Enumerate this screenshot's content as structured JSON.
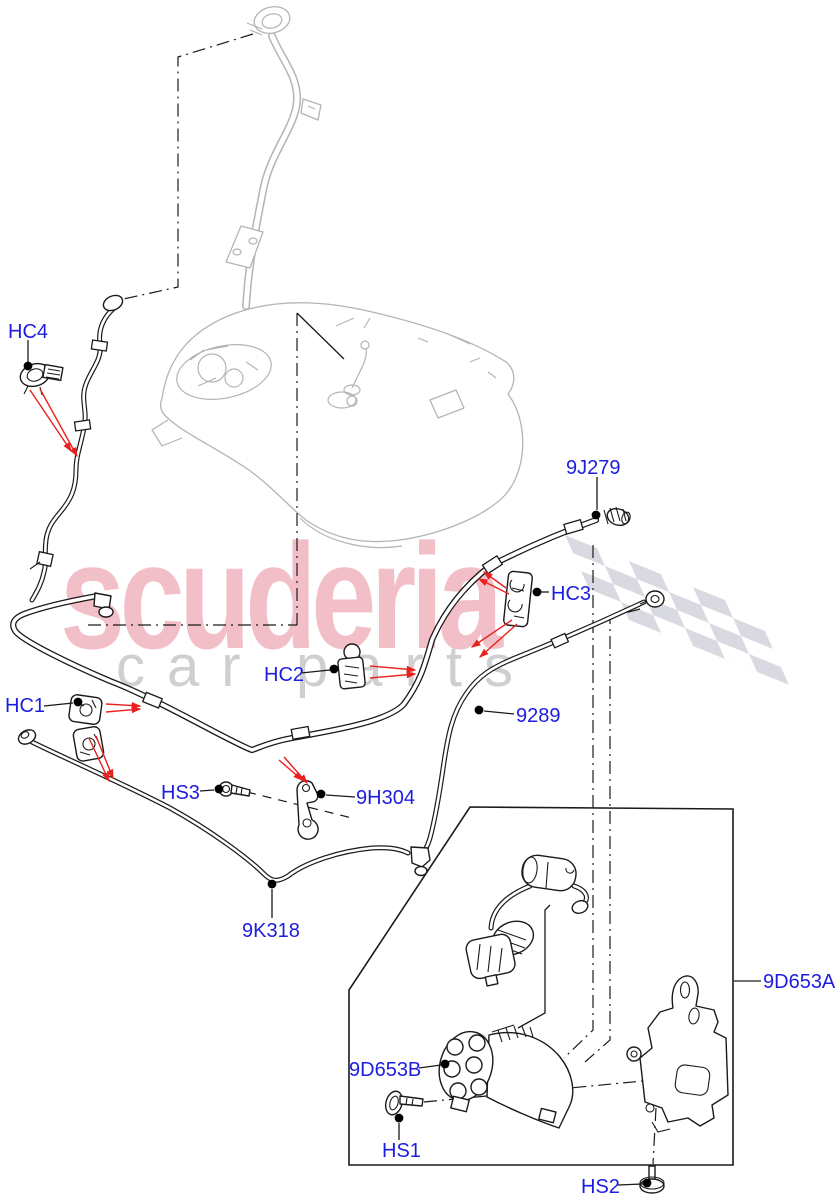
{
  "watermark": {
    "brand": "scuderia",
    "tagline_left": "car",
    "tagline_right": "parts"
  },
  "colors": {
    "label_blue": "#1d1de0",
    "arrow_red": "#e8211e",
    "watermark_pink": "#f2bec7",
    "watermark_gray": "#cfcfcf",
    "flag_gray": "#d9d9e2",
    "sketch_gray": "#b4b4b4",
    "line_black": "#1a1a1a"
  },
  "parts": [
    {
      "id": "HC4",
      "label": "HC4"
    },
    {
      "id": "9J279",
      "label": "9J279"
    },
    {
      "id": "HC3",
      "label": "HC3"
    },
    {
      "id": "HC2",
      "label": "HC2"
    },
    {
      "id": "HC1",
      "label": "HC1"
    },
    {
      "id": "9289",
      "label": "9289"
    },
    {
      "id": "HS3",
      "label": "HS3"
    },
    {
      "id": "9H304",
      "label": "9H304"
    },
    {
      "id": "9K318",
      "label": "9K318"
    },
    {
      "id": "9D653A",
      "label": "9D653A"
    },
    {
      "id": "9D653B",
      "label": "9D653B"
    },
    {
      "id": "HS1",
      "label": "HS1"
    },
    {
      "id": "HS2",
      "label": "HS2"
    }
  ]
}
